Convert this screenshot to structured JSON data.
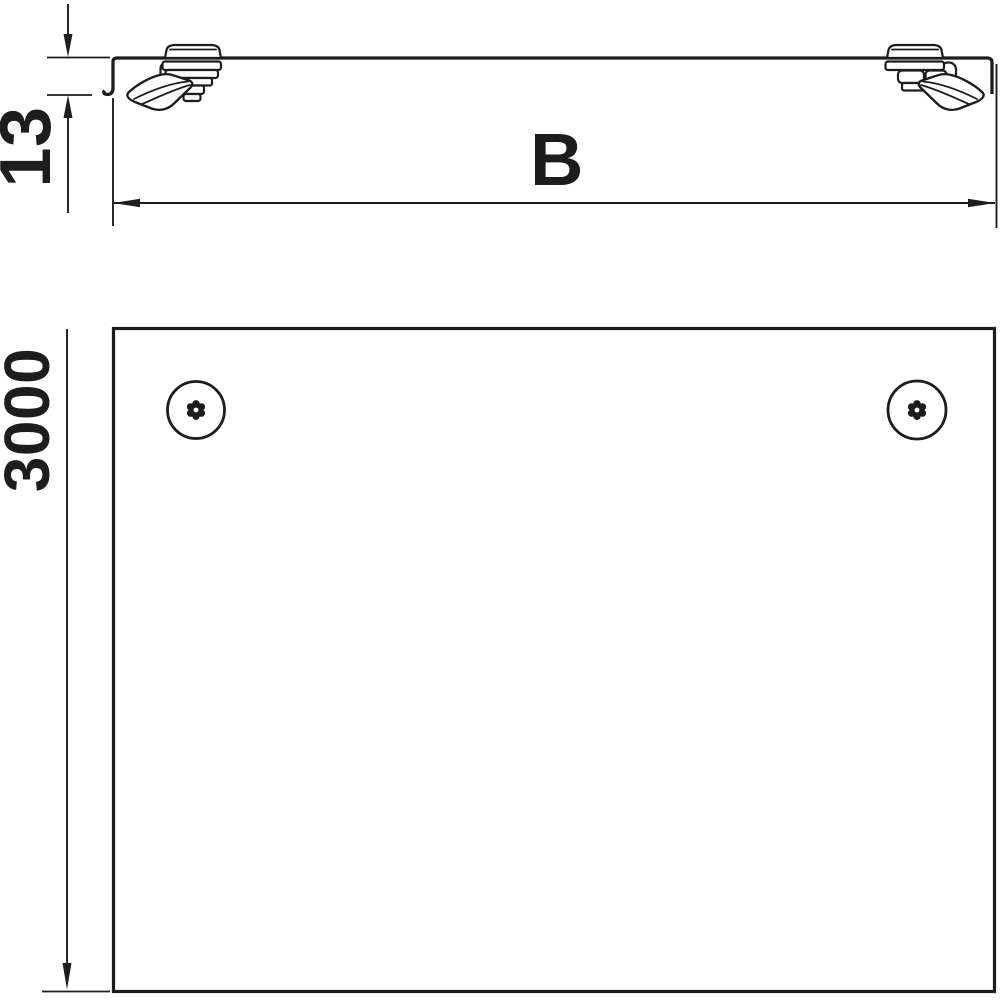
{
  "meta": {
    "background_color": "#ffffff",
    "line_color": "#1d1d1d",
    "drawing_type": "cover-with-turnbuckle-dimension-drawing"
  },
  "profile_view": {
    "height_dimension_label": "13",
    "width_dimension_label": "B"
  },
  "plan_view": {
    "length_dimension_label": "3000"
  }
}
